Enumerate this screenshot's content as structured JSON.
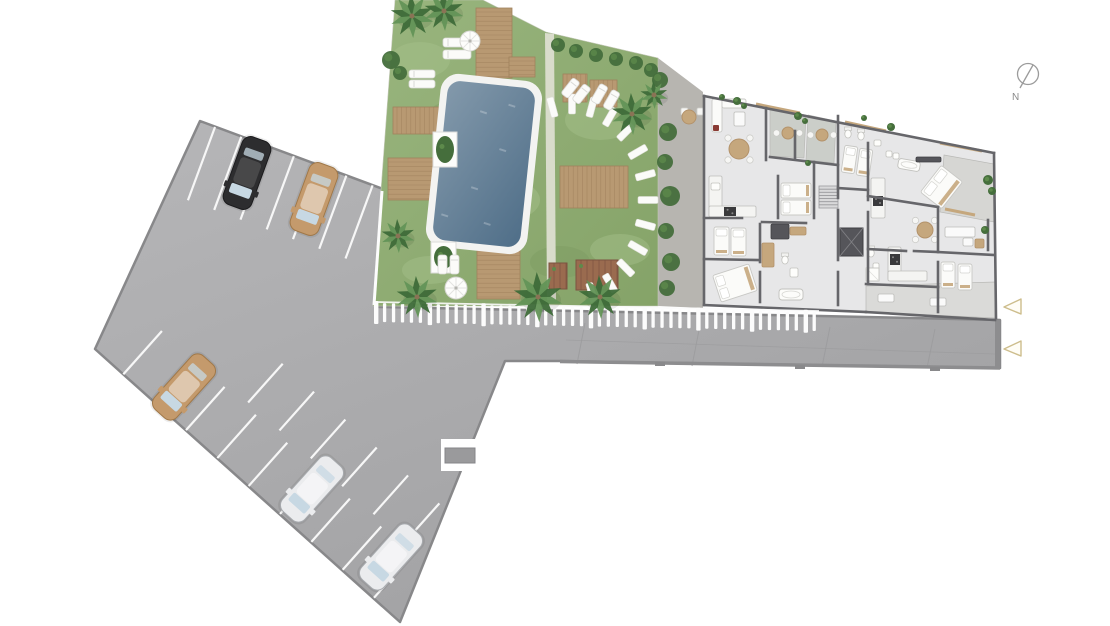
{
  "meta": {
    "type": "architectural-site-plan",
    "view": "top-down"
  },
  "compass": {
    "label": "N",
    "cx": 1028,
    "cy": 74,
    "r": 10.5,
    "needle": [
      1033,
      65,
      1020,
      88
    ],
    "label_pos": [
      1012,
      100
    ]
  },
  "colors": {
    "bg": "#ffffff",
    "lotA": "#b6b6b8",
    "lotB": "#a0a0a2",
    "lotStroke": "#88888a",
    "line": "#f7f7f7",
    "curb": "#8d8d8f",
    "joint": "#9b9b9d",
    "lawnA": "#99b57e",
    "lawnB": "#85a368",
    "lawnLight": "#a6c08c",
    "lawnDark": "#78985e",
    "pathGray": "#b7b5b0",
    "pathDivider": "#d9dccb",
    "wood": "#b89972",
    "woodLine": "#a0815c",
    "pool1": "#8399ab",
    "pool2": "#4f6e88",
    "coping": "#f3f3f1",
    "planterWood": "#9a6b4f",
    "planterLine": "#7c5340",
    "fence": "#fcfcfc",
    "bush": "#456e3c",
    "bushLight": "#5d8a4b",
    "palm1": "#3e6b39",
    "palm2": "#639457",
    "trunk": "#8a7355",
    "floor": "#e7e7e8",
    "terrace": "#cbcec9",
    "terraceTR": "#d6d6d3",
    "terraceBR": "#dadad8",
    "wall": "#66666a",
    "wall2": "#55555a",
    "fix": "#f4f4f2",
    "fixStroke": "#bdbdba",
    "tan": "#c5a77d",
    "tanDark": "#b3926a",
    "white": "#fafafa",
    "red": "#8a3b34",
    "stove": "#3a3a3c",
    "glass": "#c7d8e3",
    "carBlack": "#2d2d2f",
    "carBlackS": "#1b1b1d",
    "carTan": "#c49a6c",
    "carTanS": "#a07848",
    "carWhite": "#ebecee",
    "carWhiteS": "#a7aaae",
    "triStroke": "#cdbd8c",
    "triFill": "#fffdf6",
    "compass": "#9b9b9b",
    "compassText": "#8a8a8a",
    "stone": "#fbfbf9",
    "stoneStroke": "#e0e0da"
  },
  "parking": {
    "lot_poly": "200,121 383,189 379,307 820,316 1000,320 1000,368 560,361 505,361 400,622 95,349",
    "rows": [
      {
        "b": [
          200,
          121.5
        ],
        "u": [
          0.938,
          0.347
        ],
        "n": [
          -0.347,
          0.938
        ],
        "off": 0,
        "ts": [
          16,
          44,
          72,
          100,
          128,
          156,
          184
        ],
        "len": 78
      },
      {
        "b": [
          95,
          349
        ],
        "u": [
          0.746,
          0.665
        ],
        "n": [
          0.665,
          -0.746
        ],
        "off": 0,
        "ts": [
          38,
          80,
          122,
          164,
          206,
          248,
          290,
          332,
          374
        ],
        "len": 58
      },
      {
        "b": [
          95,
          349
        ],
        "u": [
          0.746,
          0.665
        ],
        "n": [
          0.665,
          -0.746
        ],
        "off": 62,
        "ts": [
          150,
          192,
          234,
          276,
          318,
          360
        ],
        "len": 52
      }
    ],
    "cars": [
      [
        247,
        173,
        200,
        "carBlack"
      ],
      [
        314,
        199,
        200,
        "carTan"
      ],
      [
        184,
        387,
        222,
        "carTan"
      ],
      [
        312,
        489,
        222,
        "carWhite"
      ],
      [
        391,
        557,
        222,
        "carWhite"
      ]
    ],
    "notch": {
      "rect": [
        441,
        439,
        47,
        32
      ],
      "tab": [
        445,
        448,
        30,
        15
      ]
    },
    "joints": [
      [
        585,
        323,
        577,
        364
      ],
      [
        700,
        325,
        692,
        366
      ],
      [
        830,
        327,
        822,
        367
      ],
      [
        935,
        329,
        927,
        368
      ]
    ],
    "long_joint": [
      566,
      340,
      995,
      354
    ],
    "curb": [
      560,
      361.5,
      1000,
      368
    ],
    "cap": [
      995,
      320,
      5,
      49
    ],
    "stubs": [
      [
        655,
        362
      ],
      [
        795,
        365
      ],
      [
        930,
        367
      ]
    ]
  },
  "garden": {
    "lawn_poly": "395,0 483,0 546,32 658,58 658,306 373,306 381,190",
    "path_poly": "658,58 703,92 703,308 658,306",
    "divider_poly": "545,33 554,34 556,300 547,300",
    "blotches": [
      [
        420,
        60,
        30,
        18
      ],
      [
        500,
        200,
        40,
        22
      ],
      [
        600,
        120,
        35,
        20
      ],
      [
        430,
        270,
        28,
        14
      ],
      [
        620,
        250,
        30,
        16
      ]
    ],
    "dark_patches": [
      [
        460,
        120,
        36,
        20
      ],
      [
        560,
        262,
        30,
        16
      ]
    ],
    "pool": {
      "cx": 484,
      "cy": 164,
      "w": 88,
      "h": 160,
      "rot": 6,
      "pad": 7
    },
    "white_planters": [
      [
        433,
        132,
        24,
        35
      ],
      [
        431,
        242,
        25,
        31
      ]
    ],
    "decks": [
      [
        476,
        8,
        36,
        70,
        "h"
      ],
      [
        509,
        57,
        26,
        20,
        "h"
      ],
      [
        393,
        107,
        76,
        27,
        "v"
      ],
      [
        388,
        158,
        82,
        42,
        "h"
      ],
      [
        477,
        247,
        43,
        52,
        "h"
      ],
      [
        560,
        166,
        68,
        42,
        "v"
      ],
      [
        563,
        74,
        24,
        28,
        "v"
      ],
      [
        590,
        80,
        27,
        27,
        "v"
      ]
    ],
    "brown_planters": [
      [
        549,
        263,
        18,
        26
      ],
      [
        576,
        260,
        42,
        30
      ]
    ],
    "loungers": [
      [
        443,
        38,
        28,
        9,
        0
      ],
      [
        443,
        50,
        28,
        9,
        0
      ],
      [
        409,
        70,
        26,
        8,
        0
      ],
      [
        409,
        80,
        26,
        8,
        0
      ],
      [
        438,
        255,
        9,
        19,
        0
      ],
      [
        450,
        255,
        9,
        19,
        0
      ],
      [
        566,
        78,
        9,
        20,
        38
      ],
      [
        577,
        84,
        9,
        20,
        38
      ],
      [
        595,
        84,
        9,
        20,
        30
      ],
      [
        607,
        90,
        9,
        20,
        30
      ]
    ],
    "umbrellas": [
      [
        470,
        41,
        10
      ],
      [
        456,
        288,
        11
      ]
    ],
    "stepping_arc": {
      "cx": 572,
      "cy": 200,
      "rx": 76,
      "ry": 96,
      "a0": -105,
      "a1": 75,
      "step": 15,
      "l": 20,
      "w": 7
    },
    "cafe": {
      "table": [
        689,
        117,
        7
      ],
      "chairs": [
        [
          681,
          108
        ],
        [
          697,
          108
        ]
      ]
    },
    "bushes": [
      [
        391,
        60,
        9
      ],
      [
        400,
        73,
        7
      ],
      [
        558,
        45,
        7
      ],
      [
        576,
        51,
        7
      ],
      [
        596,
        55,
        7
      ],
      [
        616,
        59,
        7
      ],
      [
        636,
        63,
        7
      ],
      [
        651,
        70,
        7
      ],
      [
        660,
        80,
        8
      ],
      [
        668,
        132,
        9
      ],
      [
        665,
        162,
        8
      ],
      [
        670,
        196,
        10
      ],
      [
        666,
        231,
        8
      ],
      [
        671,
        262,
        9
      ],
      [
        667,
        288,
        8
      ]
    ],
    "palms": [
      [
        412,
        16,
        22
      ],
      [
        444,
        11,
        20
      ],
      [
        398,
        236,
        17
      ],
      [
        417,
        297,
        21
      ],
      [
        538,
        297,
        25
      ],
      [
        600,
        297,
        22
      ],
      [
        632,
        114,
        21
      ],
      [
        654,
        95,
        14
      ]
    ]
  },
  "fence": {
    "x0": 374,
    "x1": 819,
    "y0": 303,
    "slope": 0.0205,
    "step": 8.95,
    "count": 50,
    "rail": [
      374,
      302,
      819,
      311
    ],
    "left_line": [
      382,
      191,
      374,
      305
    ]
  },
  "building": {
    "outline": "704,96 994,153 996,318 866,312 704,305",
    "terraces": [
      [
        "770,108 806,115 804,158 770,156",
        "terrace"
      ],
      [
        "808,115 836,121 834,163 806,160",
        "terrace"
      ],
      [
        "944,155 994,164 994,222 940,212",
        "terraceTR"
      ],
      [
        "866,286 995,282 995,318 866,312",
        "terraceBR"
      ]
    ],
    "walls": [
      [
        704,
        96,
        704,
        305
      ],
      [
        704,
        96,
        994,
        153
      ],
      [
        994,
        153,
        996,
        318
      ],
      [
        704,
        305,
        866,
        312
      ],
      [
        866,
        312,
        995,
        320
      ],
      [
        766,
        108,
        766,
        160
      ],
      [
        704,
        218,
        742,
        218
      ],
      [
        760,
        224,
        760,
        262
      ],
      [
        760,
        272,
        760,
        302
      ],
      [
        704,
        259,
        758,
        260
      ],
      [
        762,
        222,
        806,
        223
      ],
      [
        814,
        162,
        814,
        218
      ],
      [
        770,
        157,
        838,
        165
      ],
      [
        795,
        131,
        795,
        158
      ],
      [
        778,
        176,
        778,
        218
      ],
      [
        838,
        116,
        838,
        198
      ],
      [
        838,
        210,
        838,
        260
      ],
      [
        838,
        272,
        838,
        305
      ],
      [
        838,
        188,
        868,
        190
      ],
      [
        868,
        143,
        868,
        200
      ],
      [
        868,
        212,
        868,
        284
      ],
      [
        868,
        196,
        938,
        207
      ],
      [
        938,
        207,
        938,
        250
      ],
      [
        938,
        262,
        938,
        287
      ],
      [
        868,
        249,
        906,
        251
      ],
      [
        914,
        251,
        938,
        252
      ],
      [
        866,
        284,
        938,
        287
      ],
      [
        938,
        252,
        994,
        255
      ],
      [
        988,
        220,
        988,
        250
      ],
      [
        938,
        287,
        938,
        312
      ]
    ],
    "lintels": [
      [
        756,
        104,
        800,
        113
      ],
      [
        845,
        122,
        886,
        131
      ],
      [
        940,
        143,
        982,
        151
      ],
      [
        945,
        209,
        975,
        215
      ]
    ],
    "stairs": {
      "x": 819,
      "y": 186,
      "w": 19,
      "h": 22,
      "treads": 6
    },
    "elevator": [
      840,
      228,
      23,
      28
    ],
    "plants": [
      [
        737,
        101,
        4
      ],
      [
        744,
        106,
        3
      ],
      [
        798,
        116,
        4
      ],
      [
        805,
        121,
        3
      ],
      [
        808,
        163,
        3
      ],
      [
        864,
        118,
        3
      ],
      [
        891,
        127,
        4
      ],
      [
        988,
        180,
        5
      ],
      [
        992,
        191,
        4
      ],
      [
        985,
        230,
        4
      ],
      [
        722,
        97,
        3
      ]
    ],
    "furniture": [
      [
        "sofaL",
        712,
        99
      ],
      [
        "rect",
        734,
        112,
        11,
        14,
        0,
        "white"
      ],
      [
        "tr",
        739,
        149,
        10,
        4
      ],
      [
        "rect",
        709,
        176,
        13,
        41,
        0,
        "fix"
      ],
      [
        "rect",
        709,
        206,
        47,
        11,
        0,
        "fix"
      ],
      [
        "st",
        724,
        207,
        12,
        9
      ],
      [
        "snk",
        711,
        183,
        9,
        7
      ],
      [
        "bs",
        714,
        227,
        15,
        28,
        0
      ],
      [
        "bs",
        731,
        228,
        15,
        28,
        0
      ],
      [
        "rect",
        771,
        224,
        18,
        15,
        0,
        "wall2"
      ],
      [
        "rect",
        790,
        227,
        16,
        8,
        0,
        "tan"
      ],
      [
        "bd",
        716,
        269,
        38,
        28,
        -18
      ],
      [
        "rect",
        762,
        243,
        12,
        24,
        0,
        "tan"
      ],
      [
        "tub",
        779,
        289,
        24,
        11,
        0
      ],
      [
        "snk",
        790,
        268,
        8,
        9
      ],
      [
        "wc",
        785,
        260
      ],
      [
        "tr",
        788,
        133,
        6,
        2
      ],
      [
        "tr",
        822,
        135,
        6,
        2
      ],
      [
        "bs",
        781,
        183,
        30,
        15,
        0
      ],
      [
        "bs",
        781,
        200,
        30,
        15,
        0
      ],
      [
        "rect",
        871,
        178,
        14,
        40,
        0,
        "fix"
      ],
      [
        "st",
        873,
        196,
        10,
        10
      ],
      [
        "wc",
        848,
        134
      ],
      [
        "wc",
        861,
        136
      ],
      [
        "snk",
        874,
        140,
        7,
        6
      ],
      [
        "bs",
        843,
        146,
        13,
        27,
        8
      ],
      [
        "bs",
        858,
        149,
        13,
        27,
        8
      ],
      [
        "snk",
        886,
        151,
        6,
        6
      ],
      [
        "snk",
        893,
        153,
        6,
        6
      ],
      [
        "tub",
        898,
        160,
        22,
        10,
        10
      ],
      [
        "rect",
        916,
        157,
        25,
        5,
        0,
        "wall2"
      ],
      [
        "bd",
        928,
        170,
        27,
        34,
        38
      ],
      [
        "tr",
        925,
        230,
        8,
        4
      ],
      [
        "rect",
        888,
        247,
        13,
        33,
        0,
        "fix"
      ],
      [
        "rect",
        888,
        271,
        39,
        10,
        0,
        "fix"
      ],
      [
        "st",
        890,
        254,
        10,
        11
      ],
      [
        "rect",
        945,
        227,
        30,
        10,
        0,
        "white"
      ],
      [
        "rect",
        963,
        238,
        10,
        8,
        0,
        "white"
      ],
      [
        "rect",
        975,
        239,
        9,
        9,
        0,
        "tan"
      ],
      [
        "bs",
        941,
        262,
        14,
        26,
        0
      ],
      [
        "bs",
        958,
        264,
        14,
        26,
        0
      ],
      [
        "wc",
        871,
        253
      ],
      [
        "snk",
        873,
        263,
        6,
        6
      ],
      [
        "shw",
        866,
        268,
        13,
        13
      ],
      [
        "rect",
        878,
        294,
        16,
        8,
        0,
        "white"
      ],
      [
        "rect",
        930,
        298,
        16,
        8,
        0,
        "white"
      ]
    ]
  },
  "markers": {
    "triangles": [
      [
        1004,
        307,
        1021,
        299,
        1021,
        314
      ],
      [
        1004,
        349,
        1021,
        341,
        1021,
        356
      ]
    ]
  }
}
